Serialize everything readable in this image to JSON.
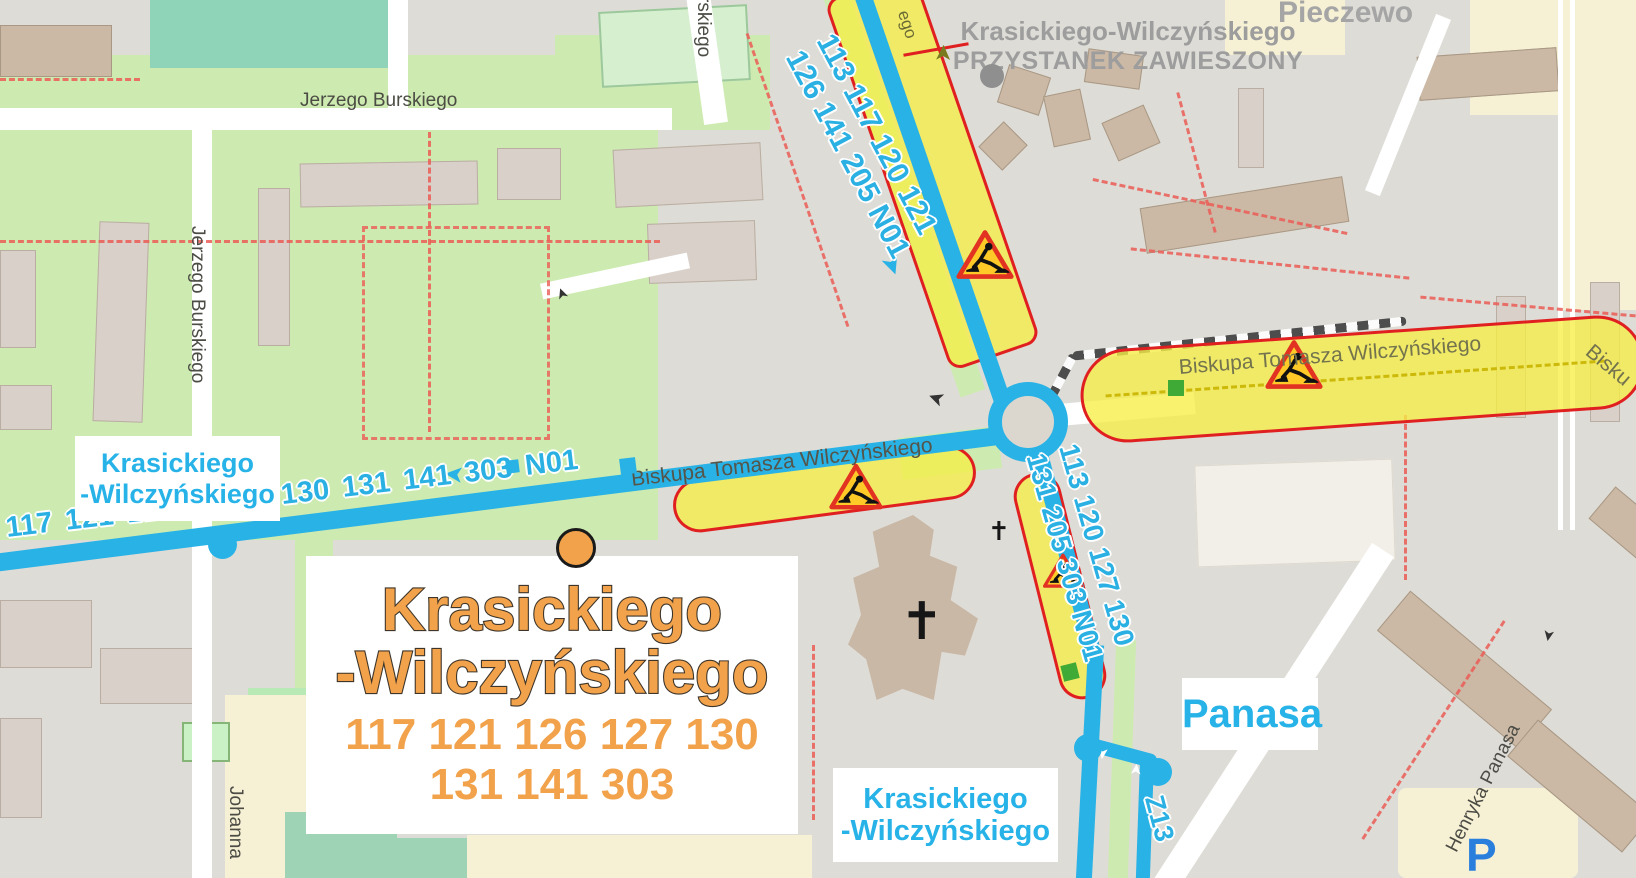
{
  "district": "Pieczewo",
  "suspended": {
    "name": "Krasickiego-Wilczyńskiego",
    "status": "PRZYSTANEK ZAWIESZONY"
  },
  "featured": {
    "name1": "Krasickiego",
    "name2": "-Wilczyńskiego",
    "routes1": "117 121 126 127 130",
    "routes2": "131 141 303"
  },
  "stops": {
    "west": {
      "l1": "Krasickiego",
      "l2": "-Wilczyńskiego"
    },
    "south": {
      "l1": "Krasickiego",
      "l2": "-Wilczyńskiego"
    },
    "panasa": "Panasa"
  },
  "routes": {
    "north": {
      "l1": "113 117 120 121",
      "l2": "126 141 205 N01"
    },
    "west": {
      "s1": "117 121 126 127",
      "s2": "130 131 141 303 N01"
    },
    "south": {
      "l1": "113 120 127 130",
      "l2": "131 205 303 N01"
    },
    "detour": "Z13"
  },
  "streets": {
    "jerzego_h": "Jerzego Burskiego",
    "jerzego_v": "Jerzego Burskiego",
    "burskiego_frag": "rskiego",
    "north_frag": "ego",
    "biskupa_w": "Biskupa Tomasza Wilczyńskiego",
    "biskupa_e": "Biskupa Tomasza Wilczyńskiego",
    "biskupa_edge": "Bisku",
    "henryka": "Henryka Panasa",
    "johanna": "Johanna"
  },
  "parking": "P",
  "symbols": {
    "arrow": "➤",
    "cross": "✝"
  },
  "colors": {
    "route_line": "#29b2e6",
    "stop_highlight": "#f1a24b",
    "construction_fill": "#f6ee46",
    "construction_border": "#e02020",
    "suspended_gray": "#9d9d9d"
  }
}
